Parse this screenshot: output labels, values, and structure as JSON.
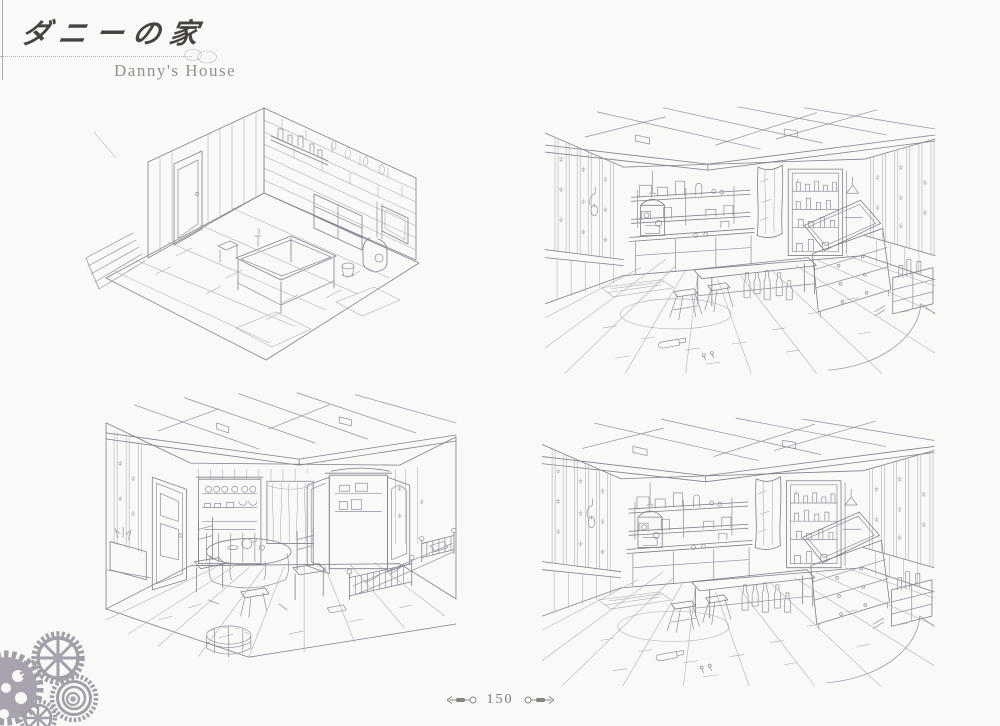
{
  "header": {
    "title_jp": "ダニーの家",
    "title_en": "Danny's House"
  },
  "footer": {
    "page_number": "150"
  },
  "icons": {
    "title_flourish": "double-ring-icon",
    "footer_left": "key-ornament-icon",
    "footer_right": "key-ornament-icon",
    "corner": "gear-cluster-icon"
  },
  "colors": {
    "paper": "#faf9f7",
    "pencil_ink": "#857e8b",
    "title_ink": "#474440",
    "subtitle_ink": "#96908a",
    "gear_gray": "#98939e"
  }
}
